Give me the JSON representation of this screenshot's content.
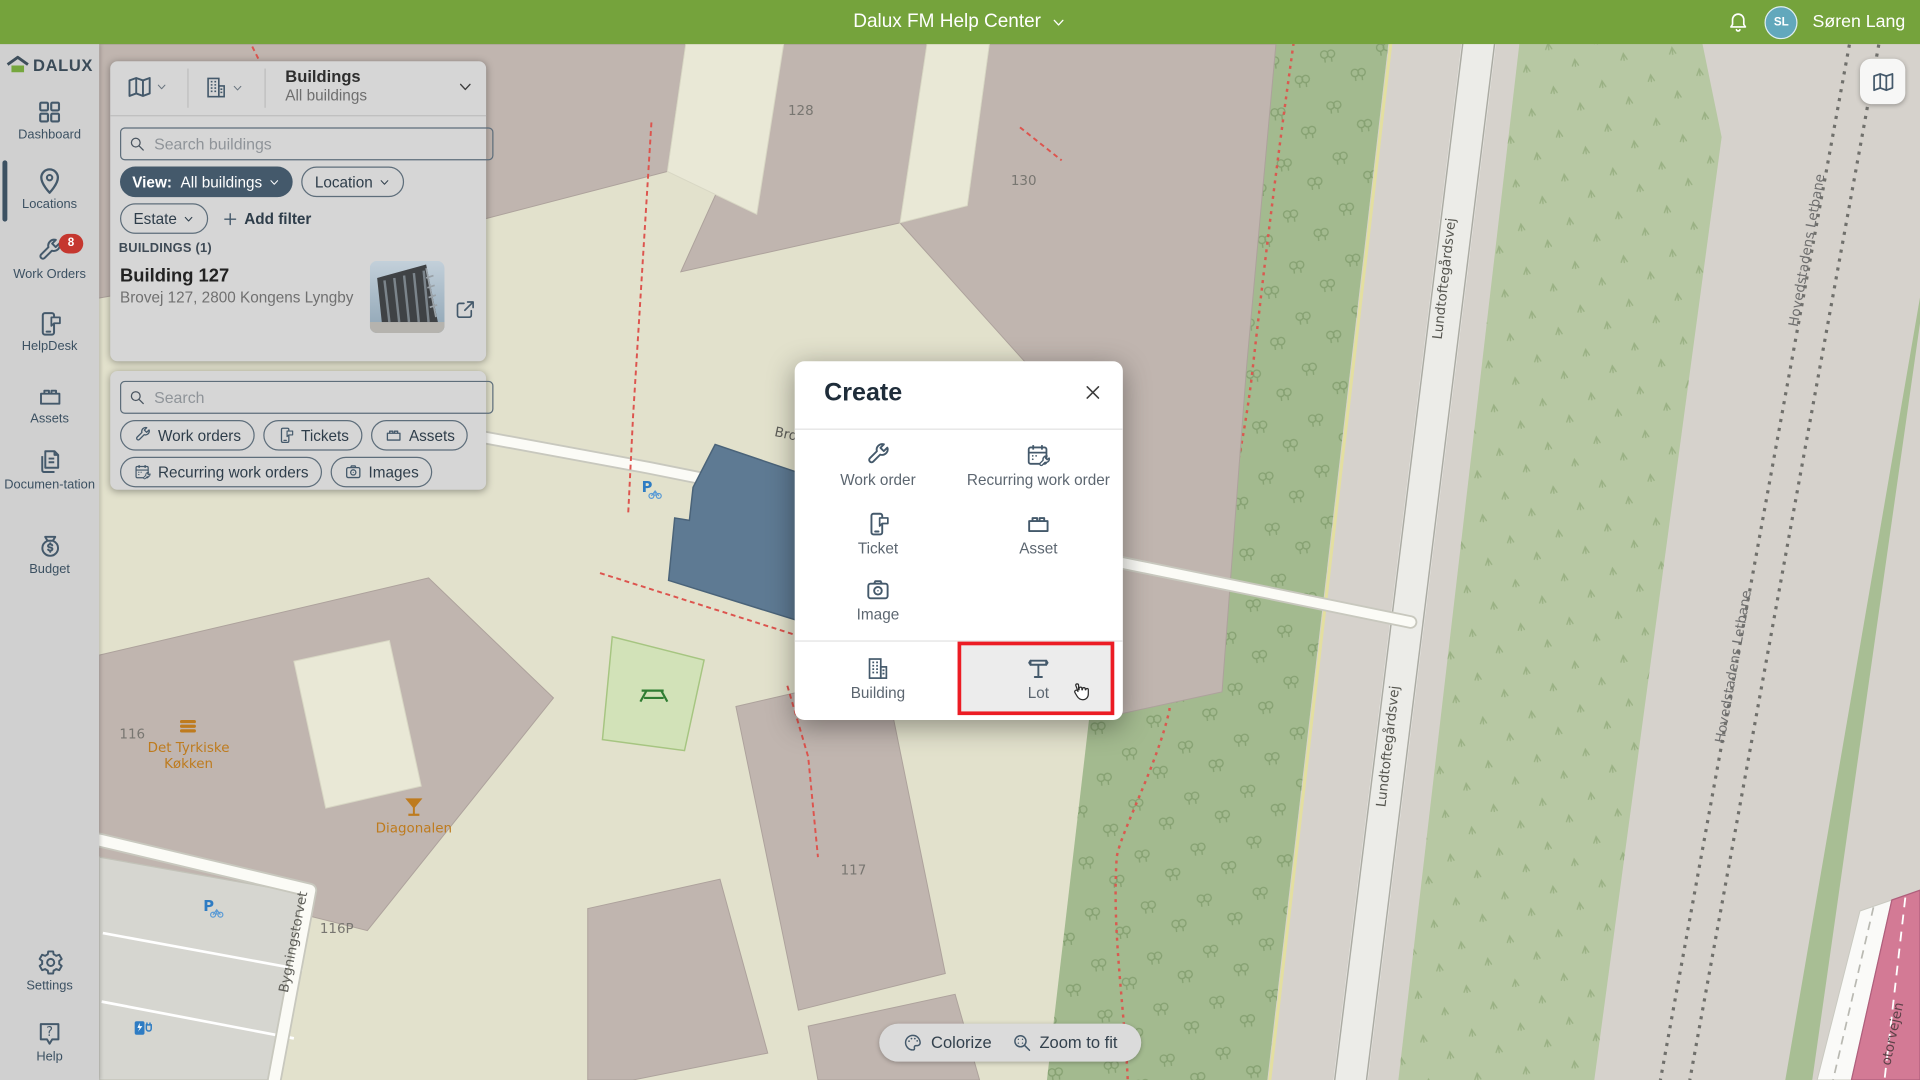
{
  "header": {
    "title": "Dalux FM Help Center",
    "user_initials": "SL",
    "user_name": "Søren Lang"
  },
  "sidebar": {
    "logo_text": "DALUX",
    "items": [
      {
        "label": "Dashboard"
      },
      {
        "label": "Locations"
      },
      {
        "label": "Work Orders",
        "badge": "8"
      },
      {
        "label": "HelpDesk"
      },
      {
        "label": "Assets"
      },
      {
        "label": "Documen-tation"
      },
      {
        "label": "Budget"
      }
    ],
    "footer_items": [
      {
        "label": "Settings"
      },
      {
        "label": "Help"
      }
    ]
  },
  "buildings_panel": {
    "title": "Buildings",
    "subtitle": "All buildings",
    "search_placeholder": "Search buildings",
    "view_filter_label": "View:",
    "view_filter_value": "All buildings",
    "location_filter": "Location",
    "estate_filter": "Estate",
    "add_filter": "Add filter",
    "section_header": "BUILDINGS (1)",
    "building_name": "Building 127",
    "building_address": "Brovej 127, 2800 Kongens Lyngby"
  },
  "search_panel": {
    "search_placeholder": "Search",
    "chips": [
      {
        "label": "Work orders"
      },
      {
        "label": "Tickets"
      },
      {
        "label": "Assets"
      },
      {
        "label": "Recurring work orders"
      },
      {
        "label": "Images"
      }
    ]
  },
  "create_modal": {
    "title": "Create",
    "options": [
      {
        "label": "Work order"
      },
      {
        "label": "Recurring work order"
      },
      {
        "label": "Ticket"
      },
      {
        "label": "Asset"
      },
      {
        "label": "Image"
      },
      {
        "label": "Building"
      },
      {
        "label": "Lot",
        "highlighted": true
      }
    ]
  },
  "map_controls": {
    "colorize": "Colorize",
    "zoom_to_fit": "Zoom to fit"
  },
  "map": {
    "labels": {
      "building_128": "128",
      "building_130": "130",
      "building_117": "117",
      "building_116": "116",
      "parking_116p": "116P",
      "poi_restaurant_line1": "Det Tyrkiske",
      "poi_restaurant_line2": "Køkken",
      "poi_bar": "Diagonalen",
      "road_bygningstorvet": "Bygningstorvet",
      "road_brovej": "Brovej",
      "road_lundtoftegardsvej": "Lundtoftegårdsvej",
      "rail_letbane": "Hovedstadens Letbane",
      "road_motorway": "otorvejen"
    }
  },
  "colors": {
    "brand_green": "#75A33C",
    "accent_red": "#EC1C24",
    "badge_red": "#C5372F",
    "avatar_teal": "#62A8BC",
    "icon_slate": "#44596B"
  }
}
